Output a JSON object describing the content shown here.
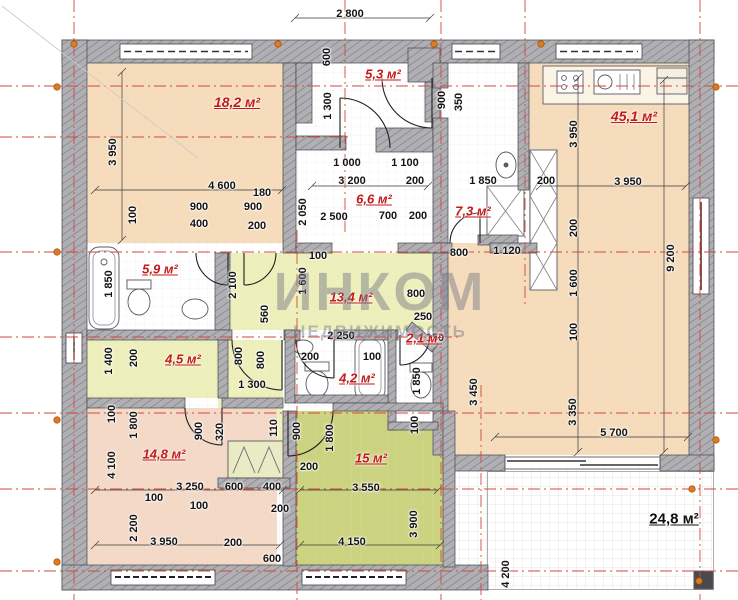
{
  "drawing": {
    "type": "floor-plan",
    "area_unit": "м²",
    "watermark": {
      "line1": "ИНКОМ",
      "line2": "НЕДВИЖИМОСТЬ"
    }
  },
  "rooms": [
    {
      "name": "bedroom-1",
      "label": "18,2 м²"
    },
    {
      "name": "entry-hall",
      "label": "5,3 м²"
    },
    {
      "name": "living-kitchen",
      "label": "45,1 м²"
    },
    {
      "name": "hallway",
      "label": "6,6 м²"
    },
    {
      "name": "utility-room",
      "label": "7,3 м²"
    },
    {
      "name": "bathroom-1",
      "label": "5,9 м²"
    },
    {
      "name": "hall",
      "label": "13,4 м²"
    },
    {
      "name": "corridor",
      "label": "4,5 м²"
    },
    {
      "name": "bathroom-2",
      "label": "4,2 м²"
    },
    {
      "name": "wc",
      "label": "2,1 м²"
    },
    {
      "name": "bedroom-2",
      "label": "14,8 м²"
    },
    {
      "name": "bedroom-3",
      "label": "15 м²"
    },
    {
      "name": "terrace",
      "label": "24,8 м²"
    }
  ],
  "dims": [
    {
      "t": "2 800"
    },
    {
      "t": "3 950"
    },
    {
      "t": "4 600"
    },
    {
      "t": "180"
    },
    {
      "t": "100"
    },
    {
      "t": "900"
    },
    {
      "t": "400"
    },
    {
      "t": "900"
    },
    {
      "t": "200"
    },
    {
      "t": "2 050"
    },
    {
      "t": "600"
    },
    {
      "t": "1 300"
    },
    {
      "t": "900"
    },
    {
      "t": "350"
    },
    {
      "t": "1 000"
    },
    {
      "t": "1 100"
    },
    {
      "t": "3 200"
    },
    {
      "t": "200"
    },
    {
      "t": "2 500"
    },
    {
      "t": "700"
    },
    {
      "t": "200"
    },
    {
      "t": "1 850"
    },
    {
      "t": "200"
    },
    {
      "t": "3 950"
    },
    {
      "t": "3 950"
    },
    {
      "t": "200"
    },
    {
      "t": "1 600"
    },
    {
      "t": "100"
    },
    {
      "t": "9 200"
    },
    {
      "t": "800"
    },
    {
      "t": "1 120"
    },
    {
      "t": "100"
    },
    {
      "t": "1 850"
    },
    {
      "t": "2 100"
    },
    {
      "t": "1 600"
    },
    {
      "t": "560"
    },
    {
      "t": "800"
    },
    {
      "t": "250"
    },
    {
      "t": "2 250"
    },
    {
      "t": "150"
    },
    {
      "t": "800"
    },
    {
      "t": "800"
    },
    {
      "t": "1 400"
    },
    {
      "t": "200"
    },
    {
      "t": "200"
    },
    {
      "t": "100"
    },
    {
      "t": "1 850"
    },
    {
      "t": "1 300"
    },
    {
      "t": "3 450"
    },
    {
      "t": "3 350"
    },
    {
      "t": "5 700"
    },
    {
      "t": "100"
    },
    {
      "t": "1 800"
    },
    {
      "t": "4 100"
    },
    {
      "t": "2 200"
    },
    {
      "t": "900"
    },
    {
      "t": "320"
    },
    {
      "t": "110"
    },
    {
      "t": "900"
    },
    {
      "t": "100"
    },
    {
      "t": "1 800"
    },
    {
      "t": "3 250"
    },
    {
      "t": "600"
    },
    {
      "t": "400"
    },
    {
      "t": "100"
    },
    {
      "t": "100"
    },
    {
      "t": "200"
    },
    {
      "t": "3 550"
    },
    {
      "t": "200"
    },
    {
      "t": "3 900"
    },
    {
      "t": "3 950"
    },
    {
      "t": "200"
    },
    {
      "t": "4 150"
    },
    {
      "t": "600"
    },
    {
      "t": "4 200"
    }
  ],
  "colors": {
    "room_peach": "#f6dcba",
    "room_pink": "#f4d9c6",
    "room_green": "#ccd37f",
    "room_pale_yellow": "#eef0bb",
    "wall_gray": "#b0afb4",
    "label_red": "#c41a1a",
    "axis_red": "#cf4a3c",
    "marker_orange": "#e07a20"
  }
}
